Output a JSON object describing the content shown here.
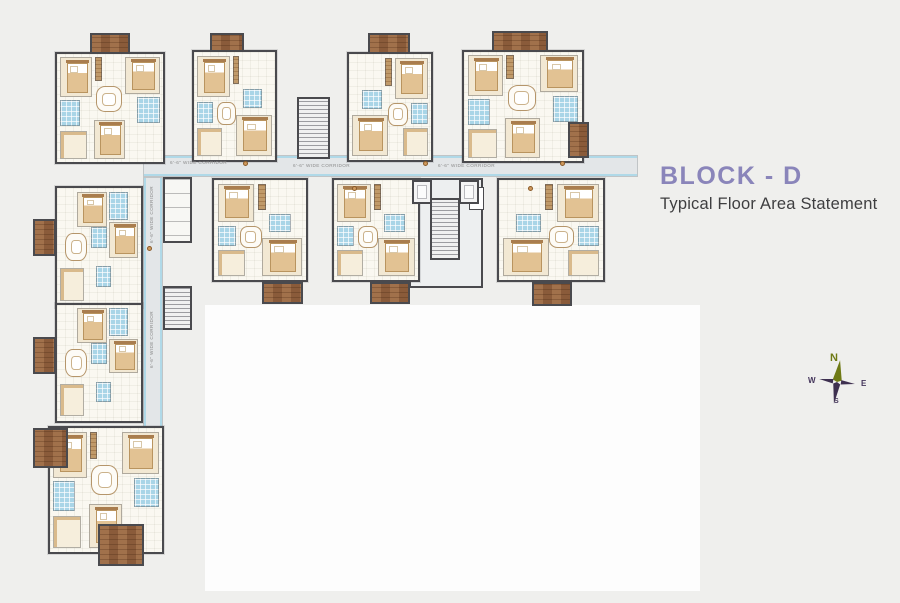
{
  "title": {
    "block": "BLOCK - D",
    "subtitle": "Typical Floor Area Statement"
  },
  "compass": {
    "n": "N",
    "e": "E",
    "w": "W",
    "s": "S"
  },
  "palette": {
    "background": "#efefed",
    "title_purple": "#8a85ba",
    "subtitle_gray": "#3e3e40",
    "wall": "#4a4a4e",
    "bathroom_blue": "#a9d5e7",
    "balcony_brown": "#9a6848",
    "bedroom_cream": "#f2e8d3",
    "corridor_gray": "#e3e6e8",
    "compass_olive": "#6f7a15",
    "compass_dark": "#44355b"
  },
  "floorplan": {
    "white_area": {
      "x": 205,
      "y": 305,
      "w": 495,
      "h": 286
    },
    "corridors": [
      {
        "x": 143,
        "y": 155,
        "w": 495,
        "h": 22,
        "dir": "h"
      },
      {
        "x": 143,
        "y": 177,
        "w": 20,
        "h": 251,
        "dir": "v"
      }
    ],
    "core": {
      "x": 409,
      "y": 178,
      "w": 74,
      "h": 110
    },
    "service": {
      "x": 163,
      "y": 177,
      "w": 29,
      "h": 66
    },
    "frame_box": {
      "x": 469,
      "y": 187,
      "w": 15,
      "h": 23
    },
    "units": [
      {
        "id": "unit-a",
        "x": 55,
        "y": 52,
        "w": 110,
        "h": 112,
        "tpl": "t3"
      },
      {
        "id": "unit-b",
        "x": 192,
        "y": 50,
        "w": 85,
        "h": 112,
        "tpl": "t2"
      },
      {
        "id": "unit-c",
        "x": 347,
        "y": 52,
        "w": 86,
        "h": 110,
        "tpl": "t2m"
      },
      {
        "id": "unit-d",
        "x": 462,
        "y": 50,
        "w": 122,
        "h": 113,
        "tpl": "t3"
      },
      {
        "id": "unit-e",
        "x": 212,
        "y": 178,
        "w": 96,
        "h": 104,
        "tpl": "t2"
      },
      {
        "id": "unit-f",
        "x": 332,
        "y": 178,
        "w": 88,
        "h": 104,
        "tpl": "t2"
      },
      {
        "id": "unit-g",
        "x": 497,
        "y": 178,
        "w": 108,
        "h": 104,
        "tpl": "t2m"
      },
      {
        "id": "unit-h",
        "x": 55,
        "y": 186,
        "w": 88,
        "h": 122,
        "tpl": "tw"
      },
      {
        "id": "unit-i",
        "x": 55,
        "y": 303,
        "w": 88,
        "h": 120,
        "tpl": "tw"
      },
      {
        "id": "unit-j",
        "x": 48,
        "y": 426,
        "w": 116,
        "h": 128,
        "tpl": "t3"
      }
    ],
    "templates": {
      "t3": [
        {
          "t": "bed",
          "x": 3,
          "y": 3,
          "w": 30,
          "h": 37
        },
        {
          "t": "bed",
          "x": 64,
          "y": 3,
          "w": 33,
          "h": 34
        },
        {
          "t": "ward",
          "x": 36,
          "y": 3,
          "w": 6,
          "h": 22
        },
        {
          "t": "bath",
          "x": 3,
          "y": 43,
          "w": 19,
          "h": 24
        },
        {
          "t": "bath",
          "x": 75,
          "y": 40,
          "w": 22,
          "h": 24
        },
        {
          "t": "table",
          "x": 37,
          "y": 30,
          "w": 24,
          "h": 24
        },
        {
          "t": "kitchen",
          "x": 3,
          "y": 71,
          "w": 25,
          "h": 26
        },
        {
          "t": "bed",
          "x": 35,
          "y": 61,
          "w": 29,
          "h": 36
        }
      ],
      "t2": [
        {
          "t": "bed",
          "x": 4,
          "y": 4,
          "w": 40,
          "h": 38
        },
        {
          "t": "ward",
          "x": 48,
          "y": 4,
          "w": 8,
          "h": 26
        },
        {
          "t": "bath",
          "x": 60,
          "y": 34,
          "w": 24,
          "h": 18
        },
        {
          "t": "bath",
          "x": 4,
          "y": 46,
          "w": 20,
          "h": 20
        },
        {
          "t": "table",
          "x": 28,
          "y": 46,
          "w": 24,
          "h": 22
        },
        {
          "t": "kitchen",
          "x": 4,
          "y": 70,
          "w": 30,
          "h": 26
        },
        {
          "t": "bed",
          "x": 52,
          "y": 58,
          "w": 44,
          "h": 38
        }
      ],
      "t2m": [
        {
          "t": "bed",
          "x": 56,
          "y": 4,
          "w": 40,
          "h": 38
        },
        {
          "t": "ward",
          "x": 44,
          "y": 4,
          "w": 8,
          "h": 26
        },
        {
          "t": "bath",
          "x": 16,
          "y": 34,
          "w": 24,
          "h": 18
        },
        {
          "t": "bath",
          "x": 76,
          "y": 46,
          "w": 20,
          "h": 20
        },
        {
          "t": "table",
          "x": 48,
          "y": 46,
          "w": 24,
          "h": 22
        },
        {
          "t": "kitchen",
          "x": 66,
          "y": 70,
          "w": 30,
          "h": 26
        },
        {
          "t": "bed",
          "x": 4,
          "y": 58,
          "w": 44,
          "h": 38
        }
      ],
      "tw": [
        {
          "t": "bed",
          "x": 24,
          "y": 3,
          "w": 36,
          "h": 30
        },
        {
          "t": "bath",
          "x": 62,
          "y": 3,
          "w": 22,
          "h": 24
        },
        {
          "t": "bed",
          "x": 62,
          "y": 29,
          "w": 35,
          "h": 30
        },
        {
          "t": "bath",
          "x": 40,
          "y": 33,
          "w": 20,
          "h": 18
        },
        {
          "t": "table",
          "x": 10,
          "y": 38,
          "w": 26,
          "h": 24
        },
        {
          "t": "kitchen",
          "x": 4,
          "y": 68,
          "w": 28,
          "h": 28
        },
        {
          "t": "bath",
          "x": 46,
          "y": 66,
          "w": 18,
          "h": 18
        }
      ]
    },
    "stairs": [
      {
        "x": 297,
        "y": 97,
        "w": 33,
        "h": 62
      },
      {
        "x": 430,
        "y": 198,
        "w": 30,
        "h": 62
      },
      {
        "x": 163,
        "y": 286,
        "w": 29,
        "h": 44
      }
    ],
    "lifts": [
      {
        "x": 412,
        "y": 180,
        "w": 20,
        "h": 24
      },
      {
        "x": 459,
        "y": 180,
        "w": 20,
        "h": 24
      }
    ],
    "balconies": [
      {
        "x": 90,
        "y": 33,
        "w": 40,
        "h": 21
      },
      {
        "x": 210,
        "y": 33,
        "w": 34,
        "h": 19
      },
      {
        "x": 368,
        "y": 33,
        "w": 42,
        "h": 21
      },
      {
        "x": 492,
        "y": 31,
        "w": 56,
        "h": 21
      },
      {
        "x": 568,
        "y": 122,
        "w": 21,
        "h": 36
      },
      {
        "x": 262,
        "y": 282,
        "w": 41,
        "h": 22
      },
      {
        "x": 370,
        "y": 282,
        "w": 40,
        "h": 22
      },
      {
        "x": 532,
        "y": 282,
        "w": 40,
        "h": 24
      },
      {
        "x": 33,
        "y": 219,
        "w": 23,
        "h": 37
      },
      {
        "x": 33,
        "y": 337,
        "w": 23,
        "h": 37
      },
      {
        "x": 33,
        "y": 428,
        "w": 35,
        "h": 40
      },
      {
        "x": 98,
        "y": 524,
        "w": 46,
        "h": 42
      }
    ],
    "labels": [
      {
        "text": "6'-6\" WIDE CORRIDOR",
        "x": 170,
        "y": 161,
        "rot": 0
      },
      {
        "text": "6'-6\" WIDE CORRIDOR",
        "x": 293,
        "y": 164,
        "rot": 0
      },
      {
        "text": "6'-6\" WIDE CORRIDOR",
        "x": 438,
        "y": 164,
        "rot": 0
      },
      {
        "text": "6'-6\" WIDE CORRIDOR",
        "x": 150,
        "y": 243,
        "rot": -90
      },
      {
        "text": "6'-6\" WIDE CORRIDOR",
        "x": 150,
        "y": 368,
        "rot": -90
      }
    ],
    "markers": [
      {
        "x": 243,
        "y": 161
      },
      {
        "x": 423,
        "y": 161
      },
      {
        "x": 560,
        "y": 161
      },
      {
        "x": 147,
        "y": 246
      },
      {
        "x": 352,
        "y": 186
      },
      {
        "x": 528,
        "y": 186
      }
    ]
  }
}
